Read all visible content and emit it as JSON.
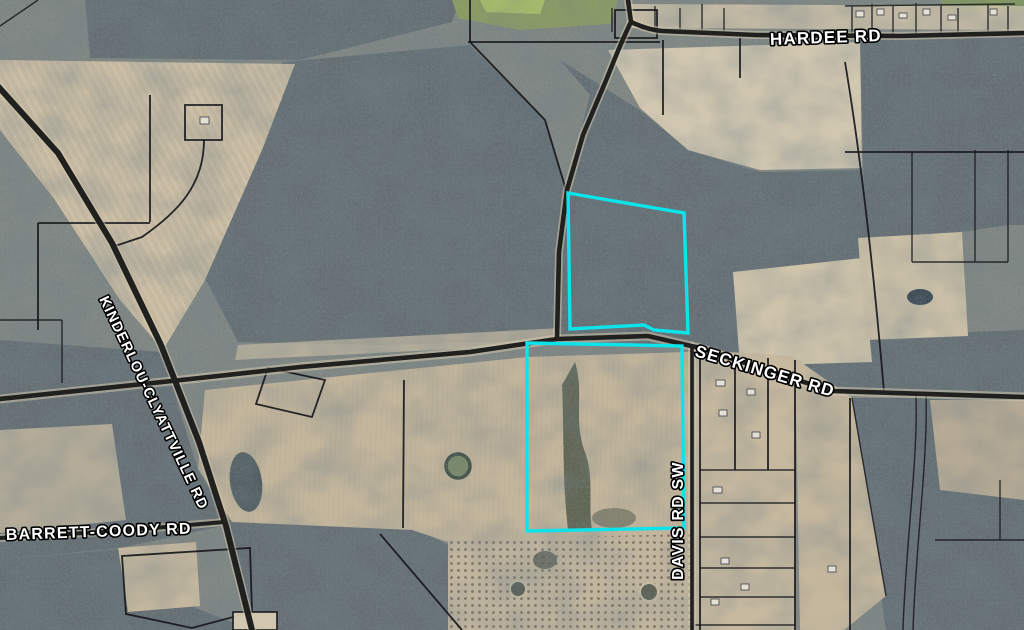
{
  "map": {
    "kind": "aerial-parcel-map",
    "roads": [
      {
        "name": "HARDEE RD"
      },
      {
        "name": "SECKINGER RD"
      },
      {
        "name": "KINDERLOU-CLYATTVILLE RD"
      },
      {
        "name": "BARRETT-COODY RD"
      },
      {
        "name": "DAVIS RD SW"
      }
    ],
    "highlight": {
      "outline_color": "#0ce4ec",
      "parcel_sections": 2
    }
  }
}
